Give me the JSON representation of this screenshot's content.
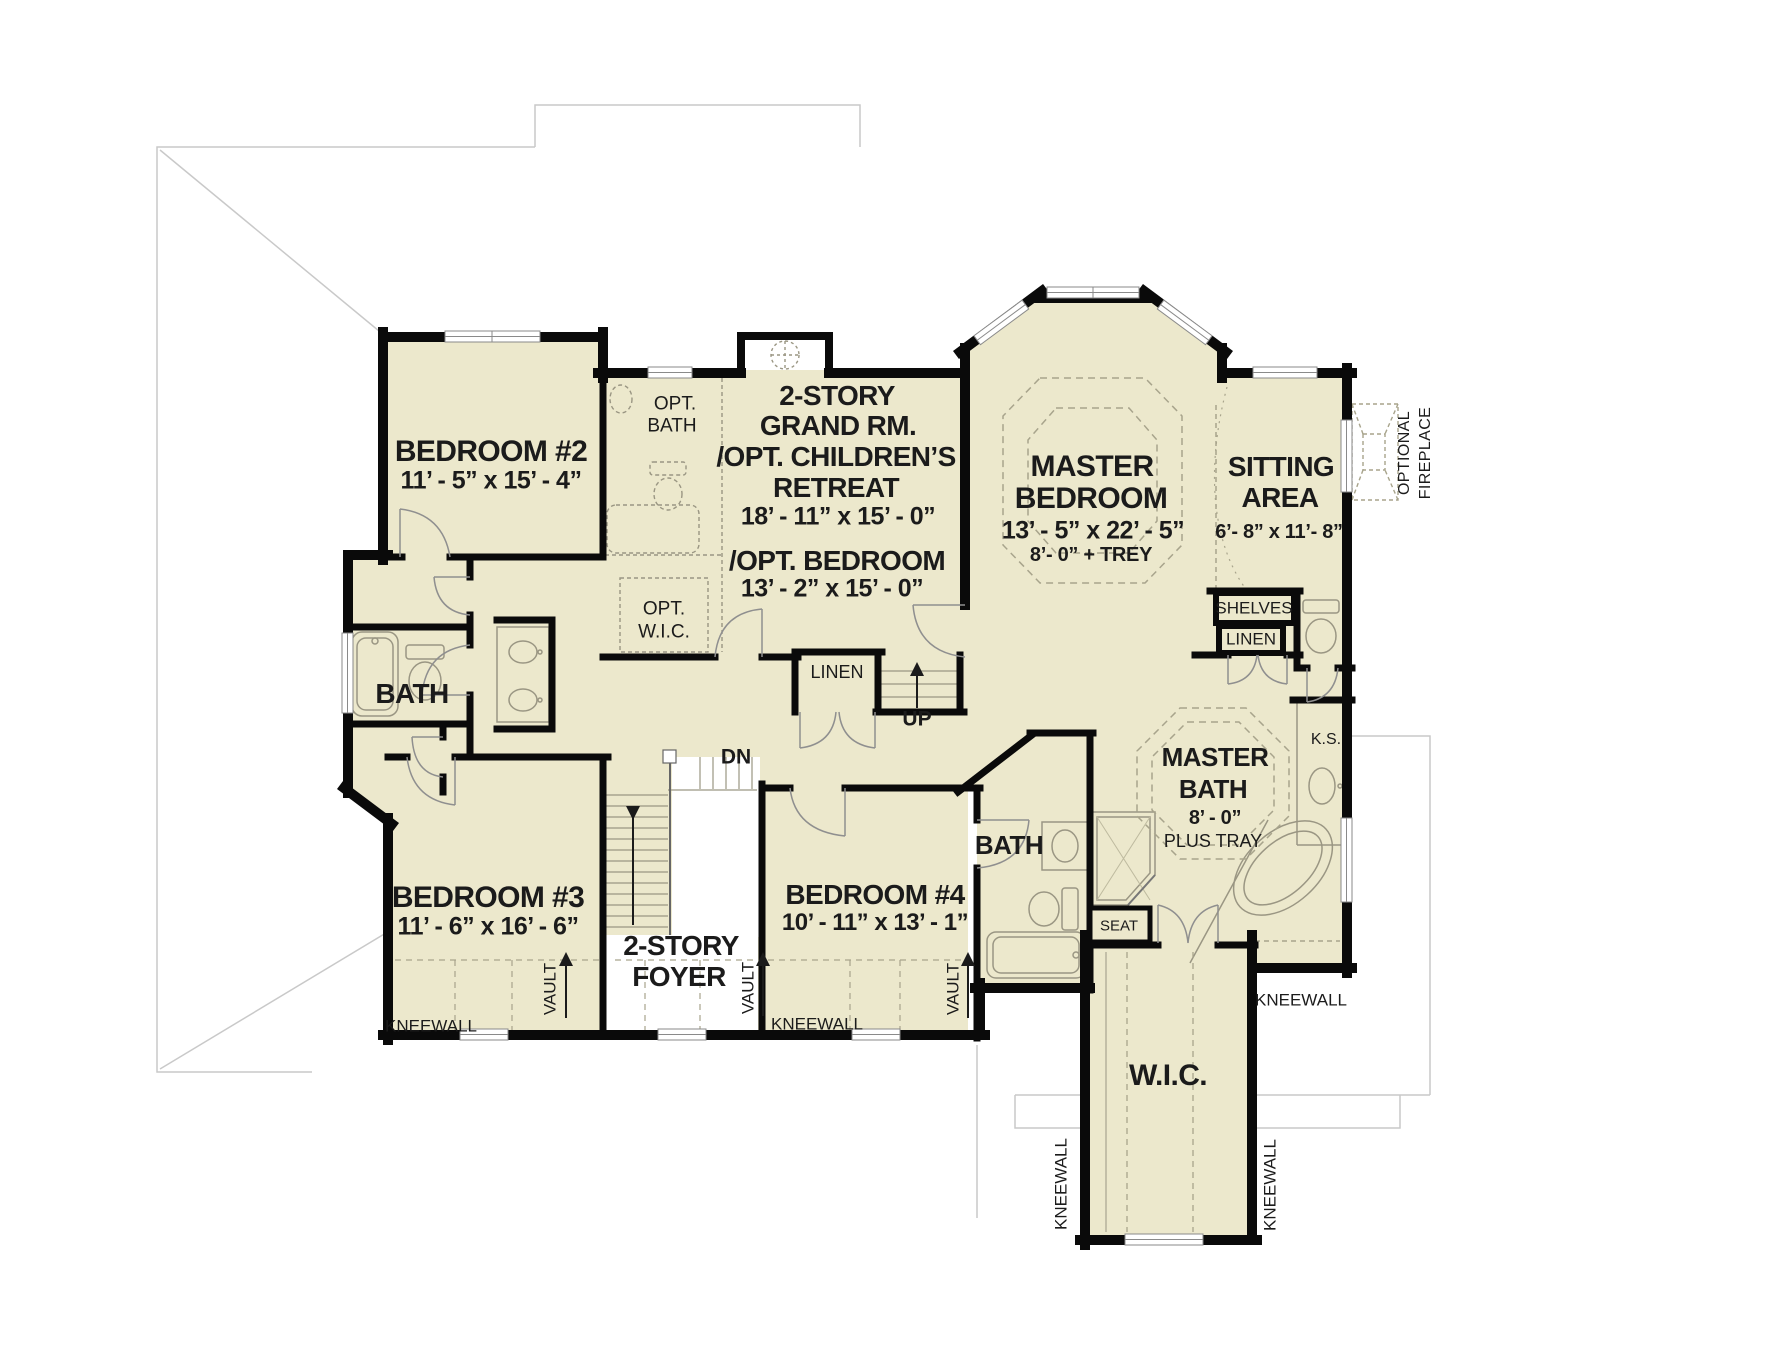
{
  "colors": {
    "room_fill": "#ece8cc",
    "wall": "#0a0a0a",
    "fixture_line": "#9a9683",
    "dashed_line": "#a8a48c",
    "roof_line": "#c9c9c9",
    "text": "#1b1b1b"
  },
  "rooms": {
    "bedroom2": {
      "name": "BEDROOM #2",
      "dims": "11’ - 5” x  15’ - 4”"
    },
    "opt_bath": {
      "line1": "OPT.",
      "line2": "BATH"
    },
    "grand_room": {
      "line1": "2-STORY",
      "line2": "GRAND RM.",
      "line3": "/OPT. CHILDREN’S",
      "line4": "RETREAT",
      "dims": "18’ - 11” x  15’ - 0”"
    },
    "opt_bedroom": {
      "name": "/OPT. BEDROOM",
      "dims": "13’ - 2” x  15’ - 0”"
    },
    "opt_wic": {
      "line1": "OPT.",
      "line2": "W.I.C."
    },
    "master_bedroom": {
      "line1": "MASTER",
      "line2": "BEDROOM",
      "dims": "13’ - 5” x  22’ - 5”",
      "ceiling": "8’- 0”  + TREY"
    },
    "sitting_area": {
      "line1": "SITTING",
      "line2": "AREA",
      "dims": "6’- 8” x  11’- 8”"
    },
    "master_bath": {
      "line1": "MASTER",
      "line2": "BATH",
      "dims": "8’ - 0”",
      "note": "PLUS TRAY"
    },
    "bath_left": {
      "name": "BATH"
    },
    "bath_center": {
      "name": "BATH"
    },
    "bedroom3": {
      "name": "BEDROOM #3",
      "dims": "11’ - 6” x  16’ - 6”"
    },
    "foyer": {
      "line1": "2-STORY",
      "line2": "FOYER"
    },
    "bedroom4": {
      "name": "BEDROOM #4",
      "dims": "10’ - 11” x  13’ - 1”"
    },
    "wic": {
      "name": "W.I.C."
    }
  },
  "labels": {
    "optional_fireplace_line1": "OPTIONAL",
    "optional_fireplace_line2": "FIREPLACE",
    "shelves": "SHELVES",
    "linen_upper": "LINEN",
    "linen_hall": "LINEN",
    "up": "UP",
    "dn": "DN",
    "ks": "K.S.",
    "seat": "SEAT",
    "kneewall": "KNEEWALL",
    "vault": "VAULT"
  }
}
